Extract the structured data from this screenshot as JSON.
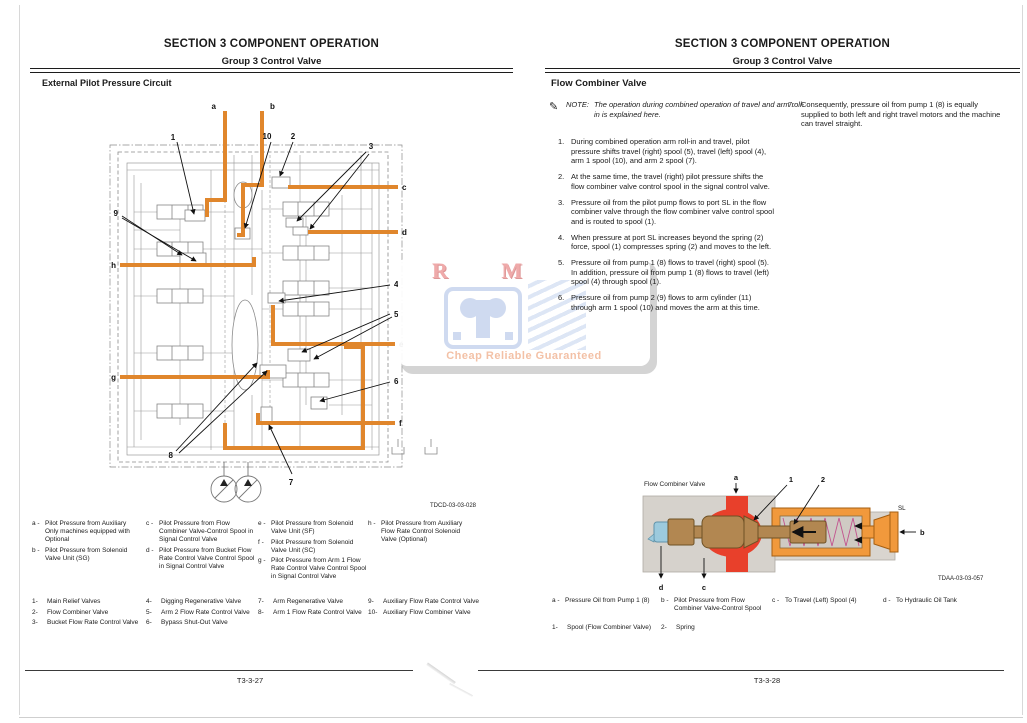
{
  "document": {
    "watermark": {
      "top": "R M",
      "bottom": "Cheap Reliable Guaranteed"
    },
    "colors": {
      "pilot_line": "#e0862c",
      "red_channel": "#e8402b",
      "spool_brown": "#b28751",
      "sleeve_orange": "#f1993c",
      "cap_blue": "#9ccadd",
      "body_gray": "#d6d2cc",
      "watermark_pink": "#efaaaa",
      "watermark_blue": "#cfdaf0",
      "watermark_text": "#f3c1a6"
    }
  },
  "left": {
    "header": {
      "title": "SECTION 3 COMPONENT OPERATION",
      "subtitle": "Group 3 Control Valve"
    },
    "section_title": "External Pilot Pressure Circuit",
    "figure_code": "TDCD-03-03-028",
    "footer": "T3-3-27",
    "callouts": {
      "a": "a",
      "b": "b",
      "c": "c",
      "d": "d",
      "e": "e",
      "f": "f",
      "g": "g",
      "h": "h",
      "n1": "1",
      "n2": "2",
      "n3": "3",
      "n4": "4",
      "n5": "5",
      "n6": "6",
      "n7": "7",
      "n8": "8",
      "n9": "9",
      "n10": "10"
    },
    "legend_letters": [
      {
        "key": "a -",
        "text": "Pilot Pressure from Auxiliary Only machines equipped with Optional"
      },
      {
        "key": "b -",
        "text": "Pilot Pressure from Solenoid Valve Unit (SG)"
      },
      {
        "key": "c -",
        "text": "Pilot Pressure from Flow Combiner Valve-Control Spool in Signal Control Valve"
      },
      {
        "key": "d -",
        "text": "Pilot Pressure from Bucket Flow Rate Control Valve Control Spool in Signal Control Valve"
      },
      {
        "key": "e -",
        "text": "Pilot Pressure from Solenoid Valve Unit (SF)"
      },
      {
        "key": "f -",
        "text": "Pilot Pressure from Solenoid Valve Unit (SC)"
      },
      {
        "key": "g -",
        "text": "Pilot Pressure from Arm 1 Flow Rate Control Valve Control Spool in Signal Control Valve"
      },
      {
        "key": "h -",
        "text": "Pilot Pressure from Auxiliary Flow Rate Control Solenoid Valve (Optional)"
      }
    ],
    "legend_numbers": [
      {
        "key": "1-",
        "text": "Main Relief Valves"
      },
      {
        "key": "2-",
        "text": "Flow Combiner Valve"
      },
      {
        "key": "3-",
        "text": "Bucket Flow Rate Control Valve"
      },
      {
        "key": "4-",
        "text": "Digging Regenerative Valve"
      },
      {
        "key": "5-",
        "text": "Arm 2 Flow Rate Control Valve"
      },
      {
        "key": "6-",
        "text": "Bypass Shut-Out Valve"
      },
      {
        "key": "7-",
        "text": "Arm Regenerative Valve"
      },
      {
        "key": "8-",
        "text": "Arm 1 Flow Rate Control Valve"
      },
      {
        "key": "9-",
        "text": "Auxiliary Flow Rate Control Valve"
      },
      {
        "key": "10-",
        "text": "Auxiliary Flow Combiner Valve"
      }
    ]
  },
  "right": {
    "header": {
      "title": "SECTION 3 COMPONENT OPERATION",
      "subtitle": "Group 3 Control Valve"
    },
    "section_title": "Flow Combiner Valve",
    "note_label": "NOTE:",
    "note_text": "The operation during combined operation of travel and arm roll-in is explained here.",
    "steps": [
      {
        "num": "1.",
        "text": "During combined operation arm roll-in and travel, pilot pressure shifts travel (right) spool (5), travel (left) spool (4), arm 1 spool (10), and arm 2 spool (7)."
      },
      {
        "num": "2.",
        "text": "At the same time, the travel (right) pilot pressure shifts the flow combiner valve control spool in the signal control valve."
      },
      {
        "num": "3.",
        "text": "Pressure oil from the pilot pump flows to port SL in the flow combiner valve through the flow combiner valve control spool and is routed to spool (1)."
      },
      {
        "num": "4.",
        "text": "When pressure at port SL increases beyond the spring (2) force, spool (1) compresses spring (2) and moves to the left."
      },
      {
        "num": "5.",
        "text": "Pressure oil from pump 1 (8) flows to travel (right) spool (5). In addition, pressure oil from pump 1 (8) flows to travel (left) spool (4) through spool (1)."
      },
      {
        "num": "6.",
        "text": "Pressure oil from pump 2 (9) flows to arm cylinder (11) through arm 1 spool (10) and moves the arm at this time."
      },
      {
        "num": "7.",
        "text": "Consequently, pressure oil from pump 1 (8) is equally supplied to both left and right travel motors and the machine can travel straight."
      }
    ],
    "diagram": {
      "label": "Flow Combiner Valve",
      "figure_code": "TDAA-03-03-057",
      "callouts": {
        "a": "a",
        "b": "b",
        "c": "c",
        "d": "d",
        "n1": "1",
        "n2": "2",
        "sl": "SL"
      }
    },
    "legend_letters": [
      {
        "key": "a -",
        "text": "Pressure Oil from Pump 1 (8)"
      },
      {
        "key": "b -",
        "text": "Pilot Pressure from Flow Combiner Valve-Control Spool"
      },
      {
        "key": "c -",
        "text": "To Travel (Left) Spool (4)"
      },
      {
        "key": "d -",
        "text": "To Hydraulic Oil Tank"
      }
    ],
    "legend_numbers": [
      {
        "key": "1-",
        "text": "Spool (Flow Combiner Valve)"
      },
      {
        "key": "2-",
        "text": "Spring"
      }
    ],
    "footer": "T3-3-28"
  }
}
